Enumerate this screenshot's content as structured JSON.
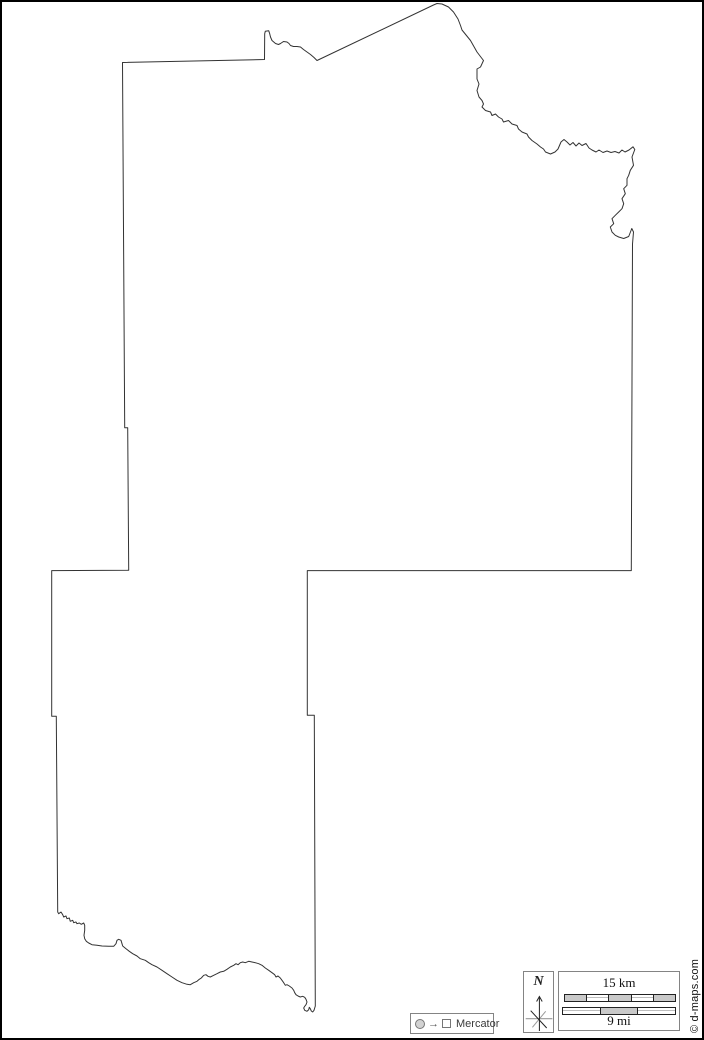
{
  "page": {
    "background": "#ffffff",
    "border_color": "#000000"
  },
  "map": {
    "stroke_color": "#333333",
    "outline_points": [
      [
        120.5,
        60.5
      ],
      [
        122.7,
        425.7
      ],
      [
        125.7,
        425.7
      ],
      [
        126.7,
        568.3
      ],
      [
        49.7,
        568.6
      ],
      [
        49.7,
        714.3
      ],
      [
        54.3,
        714.3
      ],
      [
        55.7,
        910
      ],
      [
        56.7,
        911.7
      ],
      [
        59,
        910
      ],
      [
        60.7,
        912.7
      ],
      [
        61.7,
        915
      ],
      [
        64,
        914
      ],
      [
        65,
        916.7
      ],
      [
        67.3,
        916
      ],
      [
        68.3,
        919.3
      ],
      [
        70.7,
        918.3
      ],
      [
        71.7,
        920.7
      ],
      [
        74,
        920
      ],
      [
        75,
        921.7
      ],
      [
        77.3,
        921
      ],
      [
        79.3,
        922.3
      ],
      [
        81.7,
        921
      ],
      [
        82.7,
        923.3
      ],
      [
        82.7,
        928.3
      ],
      [
        82,
        933.3
      ],
      [
        82.7,
        936.7
      ],
      [
        84.3,
        939.3
      ],
      [
        86.7,
        941
      ],
      [
        90,
        942.7
      ],
      [
        95,
        943.3
      ],
      [
        100,
        944
      ],
      [
        106.7,
        944.3
      ],
      [
        111.7,
        944.3
      ],
      [
        114,
        941.7
      ],
      [
        115,
        938.3
      ],
      [
        116.7,
        937.3
      ],
      [
        119,
        938.3
      ],
      [
        120,
        941.7
      ],
      [
        120.7,
        944
      ],
      [
        124,
        946.7
      ],
      [
        127.3,
        949.3
      ],
      [
        130.7,
        951.7
      ],
      [
        135,
        954
      ],
      [
        138.3,
        956.7
      ],
      [
        143.3,
        958.3
      ],
      [
        146.7,
        960.7
      ],
      [
        150,
        962.7
      ],
      [
        155,
        965
      ],
      [
        160,
        968.3
      ],
      [
        165,
        971.7
      ],
      [
        170,
        975
      ],
      [
        175,
        978.3
      ],
      [
        180,
        980.7
      ],
      [
        185,
        982.3
      ],
      [
        188.3,
        982.7
      ],
      [
        191.7,
        980.7
      ],
      [
        195,
        979.3
      ],
      [
        197.3,
        977.3
      ],
      [
        199.3,
        976
      ],
      [
        201.7,
        973.3
      ],
      [
        204,
        972.7
      ],
      [
        206,
        974.3
      ],
      [
        208.3,
        975
      ],
      [
        211.7,
        973.3
      ],
      [
        215,
        971.7
      ],
      [
        218.3,
        970
      ],
      [
        221.7,
        969.3
      ],
      [
        225,
        967.3
      ],
      [
        228.3,
        965
      ],
      [
        231.7,
        963.3
      ],
      [
        234,
        961.7
      ],
      [
        236,
        962.7
      ],
      [
        238.3,
        960.7
      ],
      [
        240.7,
        960
      ],
      [
        243.3,
        960.7
      ],
      [
        246.7,
        959.3
      ],
      [
        250,
        960
      ],
      [
        253.3,
        960.7
      ],
      [
        256.7,
        961.7
      ],
      [
        260,
        963.3
      ],
      [
        263.3,
        966
      ],
      [
        266.7,
        968.3
      ],
      [
        270,
        970.7
      ],
      [
        272.7,
        972.7
      ],
      [
        274,
        975
      ],
      [
        276,
        974
      ],
      [
        278.3,
        976
      ],
      [
        280,
        978.3
      ],
      [
        281.7,
        980.7
      ],
      [
        283.3,
        983.3
      ],
      [
        285,
        982.7
      ],
      [
        287.3,
        984
      ],
      [
        290,
        986
      ],
      [
        291.7,
        988.3
      ],
      [
        292.7,
        990.7
      ],
      [
        294,
        992.7
      ],
      [
        296,
        994
      ],
      [
        298.3,
        995
      ],
      [
        300.7,
        994.3
      ],
      [
        302.7,
        995.3
      ],
      [
        304,
        997.3
      ],
      [
        305,
        1000
      ],
      [
        304,
        1002.7
      ],
      [
        302.7,
        1004.3
      ],
      [
        301.7,
        1006
      ],
      [
        302.7,
        1008.3
      ],
      [
        305,
        1009.3
      ],
      [
        306.7,
        1007.7
      ],
      [
        307.3,
        1005.3
      ],
      [
        308.3,
        1006.7
      ],
      [
        309.3,
        1009
      ],
      [
        310.7,
        1010
      ],
      [
        312,
        1008.3
      ],
      [
        312.7,
        1006
      ],
      [
        313.3,
        1004
      ],
      [
        312.3,
        713.3
      ],
      [
        305.3,
        713.3
      ],
      [
        305.3,
        568.6
      ],
      [
        629.3,
        568.6
      ],
      [
        630.5,
        242
      ],
      [
        631.5,
        230
      ],
      [
        629.8,
        226.5
      ],
      [
        626.7,
        234.5
      ],
      [
        621.7,
        236.5
      ],
      [
        616.7,
        235
      ],
      [
        613.3,
        233.3
      ],
      [
        610,
        230
      ],
      [
        608.3,
        225
      ],
      [
        611.7,
        221.7
      ],
      [
        610,
        216.7
      ],
      [
        613.3,
        213.3
      ],
      [
        616.7,
        210
      ],
      [
        620,
        206.7
      ],
      [
        621.7,
        201.7
      ],
      [
        620,
        196.7
      ],
      [
        623.3,
        191.7
      ],
      [
        621.7,
        186.7
      ],
      [
        625,
        183.3
      ],
      [
        625,
        176.7
      ],
      [
        626.7,
        173.3
      ],
      [
        628.3,
        168.3
      ],
      [
        631.5,
        163.3
      ],
      [
        630,
        155
      ],
      [
        632.8,
        147.5
      ],
      [
        631,
        144.8
      ],
      [
        627,
        148
      ],
      [
        623,
        150
      ],
      [
        620,
        148
      ],
      [
        617,
        151
      ],
      [
        613,
        149.5
      ],
      [
        609,
        150.5
      ],
      [
        605,
        149
      ],
      [
        601,
        150.5
      ],
      [
        597,
        148
      ],
      [
        594,
        150
      ],
      [
        590,
        148
      ],
      [
        587,
        146
      ],
      [
        584,
        141.5
      ],
      [
        580,
        143.5
      ],
      [
        577,
        141
      ],
      [
        574,
        144
      ],
      [
        571,
        140.5
      ],
      [
        568,
        143
      ],
      [
        565,
        140
      ],
      [
        562,
        137.5
      ],
      [
        559,
        140
      ],
      [
        556,
        147
      ],
      [
        553,
        150
      ],
      [
        548.5,
        152
      ],
      [
        543.5,
        150
      ],
      [
        541.5,
        147
      ],
      [
        538.5,
        145
      ],
      [
        535,
        142
      ],
      [
        530,
        138.5
      ],
      [
        526.5,
        135
      ],
      [
        525,
        132
      ],
      [
        520,
        130
      ],
      [
        516.5,
        127
      ],
      [
        515,
        123.5
      ],
      [
        510,
        122
      ],
      [
        506.5,
        118.5
      ],
      [
        501.5,
        120
      ],
      [
        500,
        117
      ],
      [
        496.5,
        115
      ],
      [
        493.5,
        112
      ],
      [
        490,
        113.5
      ],
      [
        488.5,
        110
      ],
      [
        483.5,
        108.5
      ],
      [
        480,
        105
      ],
      [
        481.5,
        102
      ],
      [
        480,
        98.5
      ],
      [
        477,
        95
      ],
      [
        475,
        88.5
      ],
      [
        477,
        82
      ],
      [
        475,
        77
      ],
      [
        475,
        67
      ],
      [
        478.5,
        65
      ],
      [
        481.5,
        58.5
      ],
      [
        475,
        50
      ],
      [
        468.5,
        38.5
      ],
      [
        460,
        28
      ],
      [
        458.5,
        23.5
      ],
      [
        456,
        17
      ],
      [
        451.5,
        10
      ],
      [
        446.5,
        5
      ],
      [
        440,
        2
      ],
      [
        435,
        1.5
      ],
      [
        431.5,
        3
      ],
      [
        315,
        58.5
      ],
      [
        312,
        55.5
      ],
      [
        308.5,
        52.5
      ],
      [
        305,
        50
      ],
      [
        301.5,
        47.5
      ],
      [
        298.5,
        45
      ],
      [
        295,
        44.5
      ],
      [
        291.5,
        44.5
      ],
      [
        288.5,
        43.5
      ],
      [
        287,
        41.5
      ],
      [
        285,
        40
      ],
      [
        281.5,
        39.5
      ],
      [
        278.5,
        41.5
      ],
      [
        276.5,
        42.5
      ],
      [
        273.5,
        41.5
      ],
      [
        270,
        38.5
      ],
      [
        268.5,
        35
      ],
      [
        267.7,
        31.7
      ],
      [
        266.7,
        28.7
      ],
      [
        263.3,
        29.3
      ],
      [
        262.7,
        31.7
      ],
      [
        262.5,
        57.5
      ]
    ]
  },
  "projection_legend": {
    "label": "Mercator",
    "arrow_glyph": "→"
  },
  "compass": {
    "north_label": "N"
  },
  "scale_bar": {
    "km_label": "15 km",
    "mi_label": "9 mi",
    "km_pattern": [
      "gray",
      "white",
      "gray",
      "white",
      "gray"
    ],
    "mi_pattern": [
      "white",
      "gray",
      "white"
    ],
    "segment_gray": "#c9c9c9"
  },
  "credit": {
    "text": "© d-maps.com"
  }
}
